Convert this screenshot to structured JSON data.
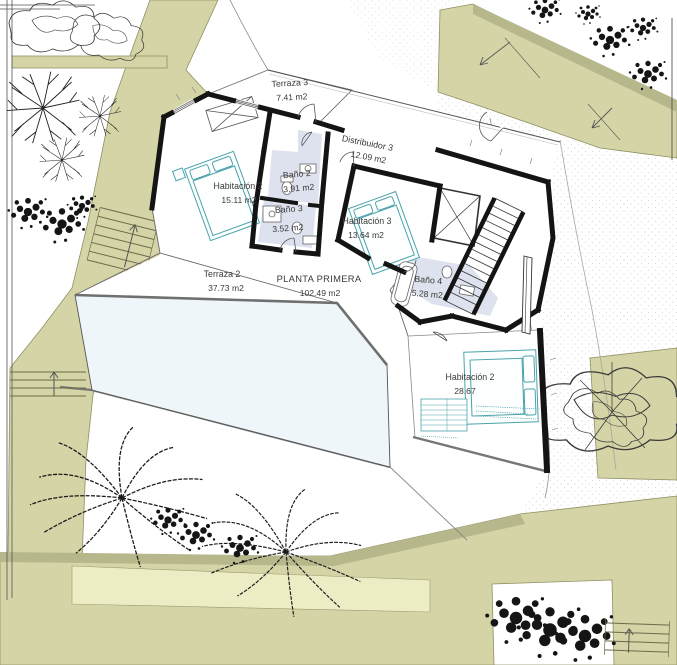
{
  "drawing": {
    "floor_title": "PLANTA PRIMERA",
    "floor_area": "102.49 m2",
    "rooms": {
      "terraza3": {
        "name": "Terraza 3",
        "area": "7.41 m2"
      },
      "distribuidor3": {
        "name": "Distribuidor 3",
        "area": "12.09 m2"
      },
      "habitacion2": {
        "name": "Habitación 2",
        "area": "15.11 m2"
      },
      "bano2": {
        "name": "Baño 2",
        "area": "3.91 m2"
      },
      "bano3": {
        "name": "Baño 3",
        "area": "3.52 m2"
      },
      "habitacion3": {
        "name": "Habitación 3",
        "area": "13.64 m2"
      },
      "terraza2": {
        "name": "Terraza 2",
        "area": "37.73 m2"
      },
      "bano4": {
        "name": "Baño 4",
        "area": "5.28 m2"
      },
      "habitacion2_lower": {
        "name": "Habitación 2",
        "area": "28.67"
      }
    },
    "colors": {
      "terrain": "#d5d4a6",
      "terrain_dark": "#b7b78c",
      "terrain_light": "#ecedc4",
      "pool": "#eef6fa",
      "bath_floor": "#dde2ee",
      "furniture_accent": "#4aa3ab",
      "wall": "#141414"
    }
  }
}
